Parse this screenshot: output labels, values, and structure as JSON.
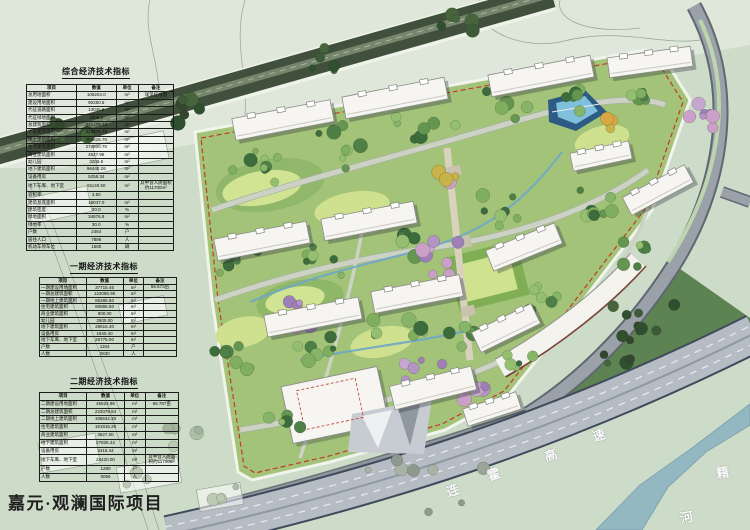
{
  "project_title": "嘉元·观澜国际项目",
  "tables": [
    {
      "title": "综合经济技术指标",
      "headers": [
        "项目",
        "数值",
        "单位",
        "备注"
      ],
      "rows": [
        [
          "总用地面积",
          "106204.0",
          "m²",
          "详见红线图"
        ],
        [
          "建设用地面积",
          "90250.5",
          "m²",
          ""
        ],
        [
          "代征道路面积",
          "13045.5",
          "m²",
          ""
        ],
        [
          "代征绿地面积",
          "2908.0",
          "m²",
          ""
        ],
        [
          "总建筑面积",
          "345175.74",
          "m²",
          ""
        ],
        [
          "计容建筑面积",
          "315876.75",
          "m²",
          ""
        ],
        [
          "地上建筑面积",
          "281828.70",
          "m²",
          ""
        ],
        [
          "住宅建筑面积",
          "272800.70",
          "m²",
          ""
        ],
        [
          "商业建筑面积",
          "4527.98",
          "m²",
          ""
        ],
        [
          "幼儿园",
          "3205.5",
          "m²",
          ""
        ],
        [
          "地下建筑面积",
          "96440.26",
          "m²",
          ""
        ],
        [
          "设备用房",
          "5258.34",
          "m²",
          ""
        ],
        [
          "地下车库、地下室",
          "91140.50",
          "m²",
          "其中含人防面积约11700m²"
        ],
        [
          "容积率",
          "3.50",
          "",
          ""
        ],
        [
          "建筑基底面积",
          "18047.0",
          "m²",
          ""
        ],
        [
          "建筑密度",
          "20.0",
          "%",
          ""
        ],
        [
          "绿地面积",
          "34876.8",
          "m²",
          ""
        ],
        [
          "绿地率",
          "30.0",
          "%",
          ""
        ],
        [
          "户数",
          "2464",
          "户",
          ""
        ],
        [
          "居住人口",
          "7886",
          "人",
          ""
        ],
        [
          "机动车停车位",
          "1680",
          "辆",
          ""
        ]
      ]
    },
    {
      "title": "一期经济技术指标",
      "headers": [
        "项目",
        "数值",
        "单位",
        "备注"
      ],
      "rows": [
        [
          "一期建设用地面积",
          "37715.45",
          "m²",
          "56.573亩"
        ],
        [
          "一期总建筑面积",
          "123095.90",
          "m²",
          ""
        ],
        [
          "一期地上建筑面积",
          "86286.50",
          "m²",
          ""
        ],
        [
          "住宅建筑面积",
          "80885.50",
          "m²",
          ""
        ],
        [
          "商业建筑面积",
          "900.00",
          "m²",
          ""
        ],
        [
          "幼儿园",
          "2500.00",
          "m²",
          ""
        ],
        [
          "地下建筑面积",
          "28615.40",
          "m²",
          ""
        ],
        [
          "设备用房",
          "1840.40",
          "m²",
          ""
        ],
        [
          "地下车库、地下室",
          "26775.00",
          "m²",
          ""
        ],
        [
          "户数",
          "1184",
          "户",
          ""
        ],
        [
          "人数",
          "2830",
          "人",
          ""
        ]
      ]
    },
    {
      "title": "二期经济技术指标",
      "headers": [
        "项目",
        "数值",
        "单位",
        "备注"
      ],
      "rows": [
        [
          "二期建设用地面积",
          "46524.95",
          "m²",
          "69.787亩"
        ],
        [
          "二期总建筑面积",
          "222079.84",
          "m²",
          ""
        ],
        [
          "二期地上建筑面积",
          "195542.20",
          "m²",
          ""
        ],
        [
          "住宅建筑面积",
          "191915.20",
          "m²",
          ""
        ],
        [
          "商业建筑面积",
          "3627.00",
          "m²",
          ""
        ],
        [
          "地下建筑面积",
          "27835.44",
          "m²",
          ""
        ],
        [
          "设备用房",
          "3415.44",
          "m²",
          ""
        ],
        [
          "地下车库、地下室",
          "24420.00",
          "m²",
          "其中含人防面积约11700m²"
        ],
        [
          "户数",
          "1280",
          "户",
          ""
        ],
        [
          "人数",
          "5056",
          "人",
          ""
        ]
      ]
    }
  ],
  "map": {
    "expressway_name": "连霍高速",
    "river_name": "籍河",
    "expressway_chars": [
      {
        "c": "连",
        "x": 446,
        "y": 480,
        "r": -21
      },
      {
        "c": "霍",
        "x": 487,
        "y": 464,
        "r": -19
      },
      {
        "c": "高",
        "x": 544,
        "y": 445,
        "r": -18
      },
      {
        "c": "速",
        "x": 592,
        "y": 425,
        "r": -17
      }
    ],
    "river_chars": [
      {
        "c": "籍",
        "x": 716,
        "y": 462,
        "r": -8
      },
      {
        "c": "河",
        "x": 680,
        "y": 507,
        "r": -10
      }
    ],
    "colors": {
      "boundary_red": "#c2392b",
      "boundary_white": "#f1f4ec",
      "site_lawn": "#a3c478",
      "building_fill": "#f6f5f1",
      "building_stroke": "#8c8d88",
      "shadow": "rgba(45,52,64,0.35)",
      "water_deep": "#2d5b84",
      "water_light": "#7fc0dd",
      "expressway": "#b6bcc4",
      "river": "#94b8c2"
    },
    "buildings": [
      [
        283,
        120,
        100,
        22,
        -11
      ],
      [
        395,
        98,
        104,
        22,
        -11
      ],
      [
        541,
        76,
        104,
        22,
        -11
      ],
      [
        650,
        62,
        84,
        20,
        -8
      ],
      [
        262,
        241,
        94,
        22,
        -11
      ],
      [
        369,
        221,
        94,
        22,
        -11
      ],
      [
        601,
        156,
        60,
        18,
        -12
      ],
      [
        658,
        190,
        70,
        20,
        -28
      ],
      [
        313,
        317,
        96,
        22,
        -11
      ],
      [
        417,
        294,
        90,
        22,
        -11
      ],
      [
        524,
        247,
        74,
        22,
        -22
      ],
      [
        506,
        328,
        66,
        22,
        -26
      ],
      [
        433,
        388,
        84,
        24,
        -14
      ],
      [
        492,
        409,
        56,
        18,
        -18
      ]
    ],
    "tree_clusters": [
      [
        265,
        168,
        9,
        40,
        "green"
      ],
      [
        345,
        150,
        8,
        38,
        "green"
      ],
      [
        425,
        126,
        7,
        34,
        "green"
      ],
      [
        505,
        106,
        7,
        30,
        "green"
      ],
      [
        575,
        92,
        6,
        26,
        "green"
      ],
      [
        645,
        95,
        6,
        22,
        "green"
      ],
      [
        703,
        117,
        7,
        20,
        "purple"
      ],
      [
        232,
        256,
        8,
        30,
        "green"
      ],
      [
        322,
        256,
        8,
        34,
        "green"
      ],
      [
        407,
        236,
        7,
        30,
        "green"
      ],
      [
        458,
        258,
        8,
        38,
        "purple"
      ],
      [
        302,
        312,
        6,
        24,
        "purple"
      ],
      [
        502,
        210,
        7,
        30,
        "green"
      ],
      [
        592,
        212,
        8,
        34,
        "green"
      ],
      [
        632,
        252,
        6,
        26,
        "green"
      ],
      [
        232,
        352,
        7,
        28,
        "green"
      ],
      [
        312,
        347,
        7,
        30,
        "green"
      ],
      [
        397,
        332,
        7,
        30,
        "green"
      ],
      [
        472,
        332,
        6,
        26,
        "green"
      ],
      [
        547,
        302,
        6,
        26,
        "green"
      ],
      [
        282,
        422,
        6,
        26,
        "green"
      ],
      [
        422,
        372,
        6,
        24,
        "purple"
      ],
      [
        472,
        390,
        8,
        22,
        "purple"
      ],
      [
        522,
        362,
        5,
        20,
        "green"
      ],
      [
        612,
        122,
        5,
        14,
        "accent"
      ],
      [
        448,
        178,
        4,
        16,
        "accent"
      ],
      [
        196,
        432,
        5,
        42,
        "pale"
      ],
      [
        152,
        472,
        4,
        30,
        "pale"
      ],
      [
        232,
        486,
        4,
        26,
        "pale"
      ],
      [
        402,
        462,
        8,
        85,
        "gray"
      ],
      [
        62,
        136,
        6,
        30,
        "dark"
      ],
      [
        182,
        103,
        6,
        30,
        "dark"
      ],
      [
        332,
        61,
        6,
        30,
        "dark"
      ],
      [
        462,
        25,
        6,
        26,
        "dark"
      ],
      [
        640,
        332,
        14,
        55,
        "dark"
      ]
    ]
  }
}
